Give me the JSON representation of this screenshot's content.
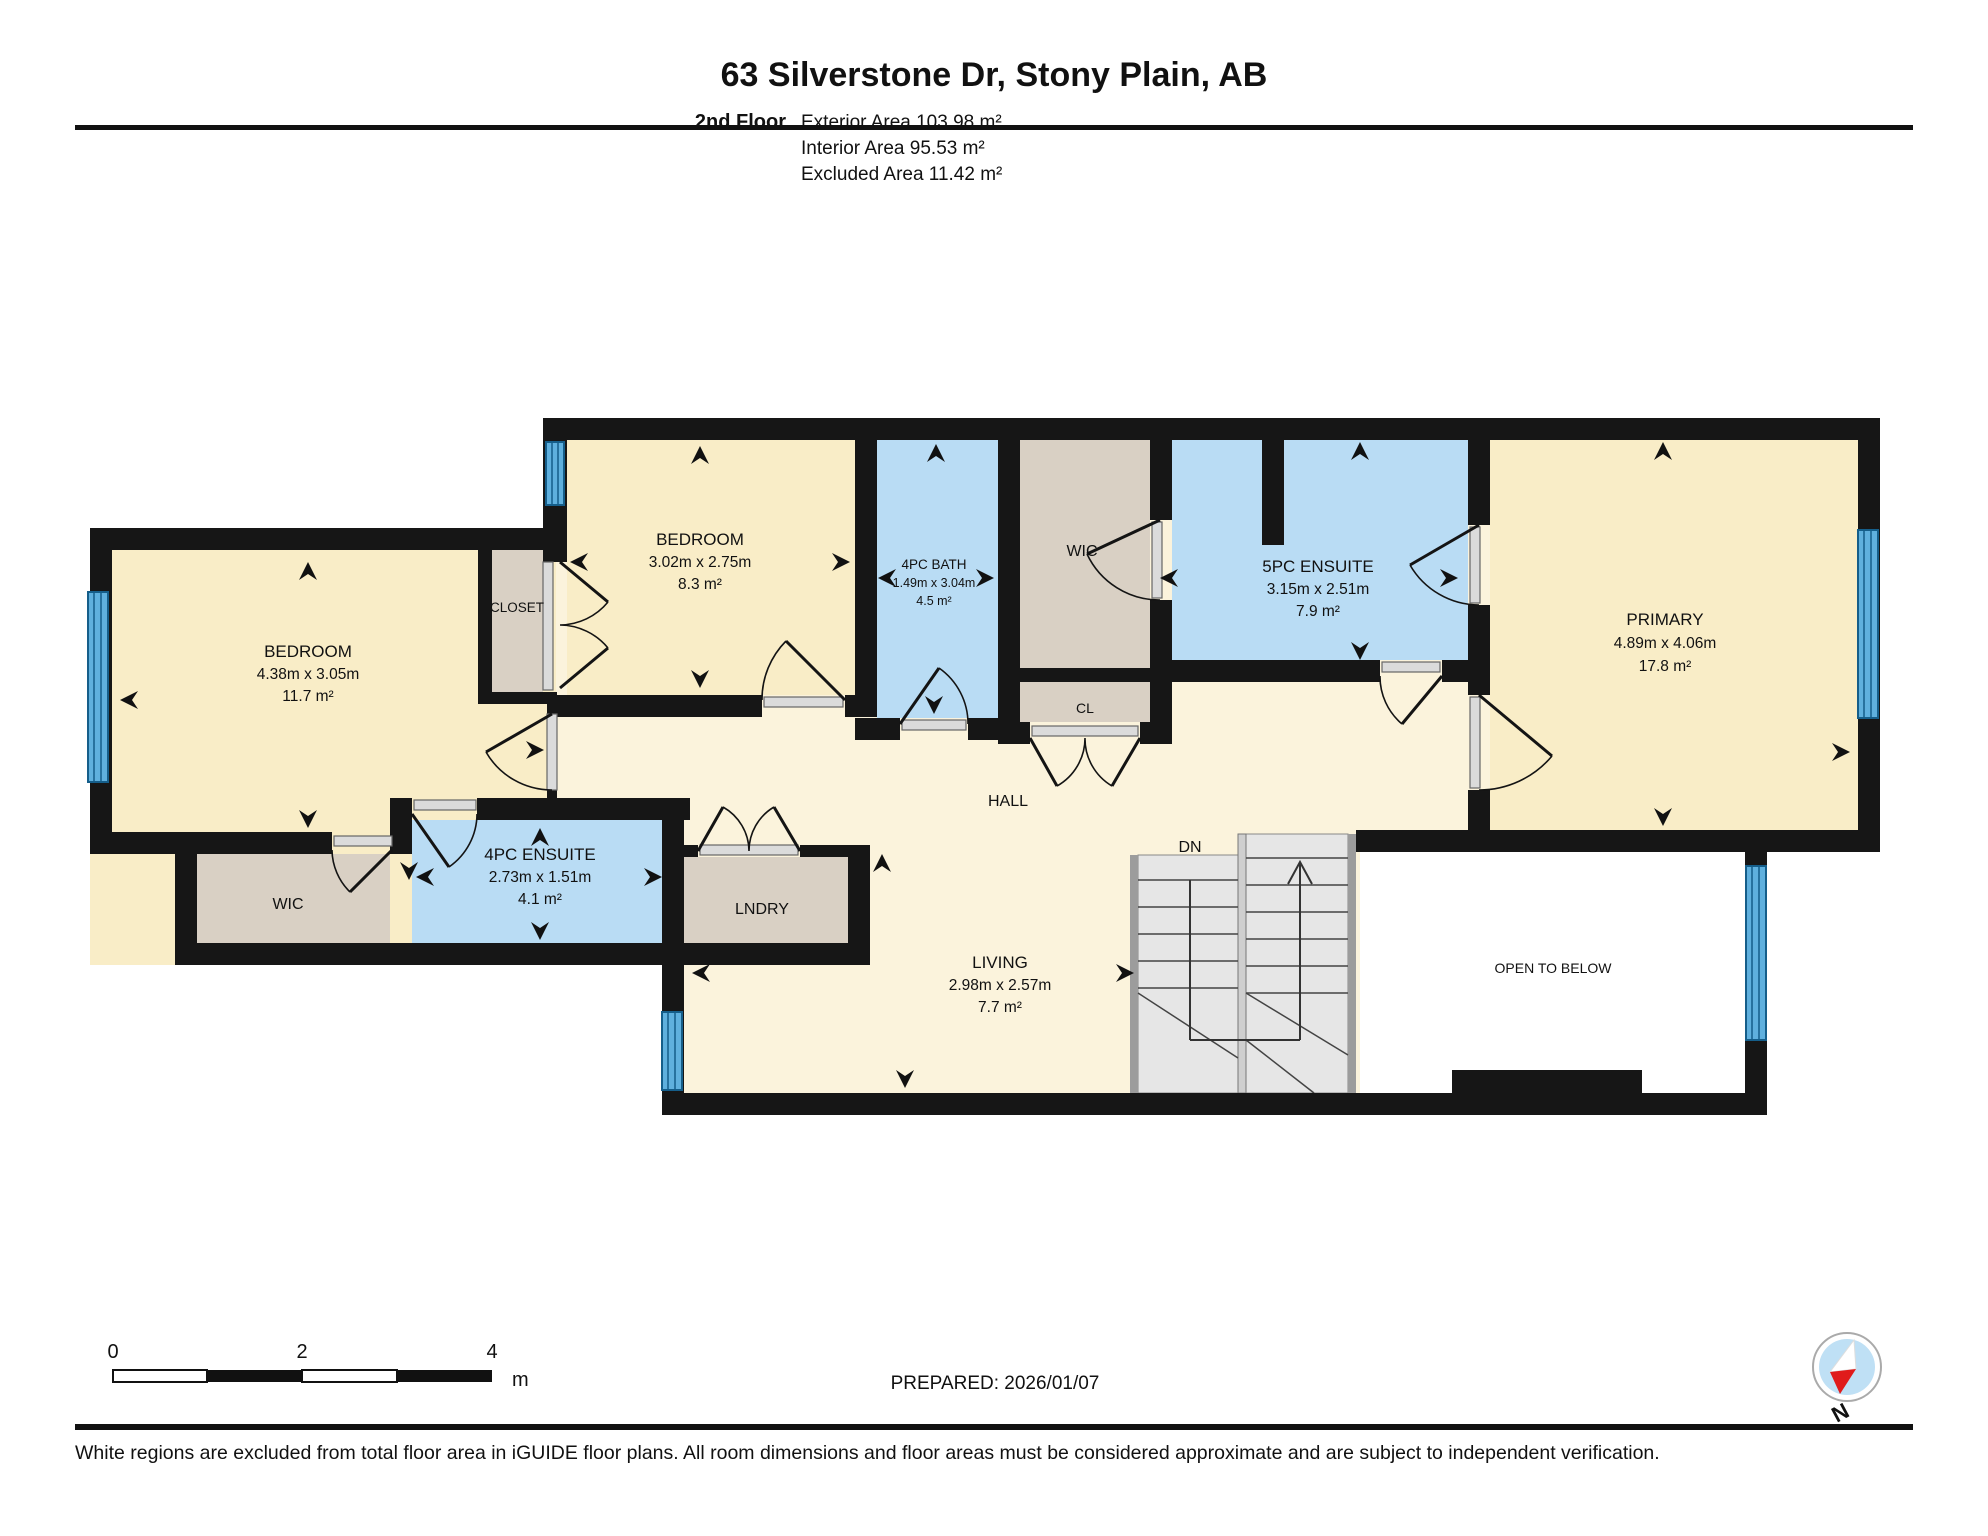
{
  "header": {
    "title": "63 Silverstone Dr, Stony Plain, AB",
    "floor_label": "2nd Floor",
    "area_lines": [
      "Exterior Area 103.98 m²",
      "Interior Area 95.53 m²",
      "Excluded Area 11.42 m²"
    ]
  },
  "rooms": {
    "bedroom_left": {
      "name": "BEDROOM",
      "dims": "4.38m x 3.05m",
      "area": "11.7 m²"
    },
    "bedroom_mid": {
      "name": "BEDROOM",
      "dims": "3.02m x 2.75m",
      "area": "8.3 m²"
    },
    "bath": {
      "name": "4PC BATH",
      "dims": "1.49m x 3.04m",
      "area": "4.5 m²"
    },
    "ensuite4": {
      "name": "4PC ENSUITE",
      "dims": "2.73m x 1.51m",
      "area": "4.1 m²"
    },
    "ensuite5": {
      "name": "5PC ENSUITE",
      "dims": "3.15m x 2.51m",
      "area": "7.9 m²"
    },
    "primary": {
      "name": "PRIMARY",
      "dims": "4.89m x 4.06m",
      "area": "17.8 m²"
    },
    "living": {
      "name": "LIVING",
      "dims": "2.98m x 2.57m",
      "area": "7.7 m²"
    },
    "closet": "CLOSET",
    "wic_left": "WIC",
    "wic_mid": "WIC",
    "cl": "CL",
    "lndry": "LNDRY",
    "hall": "HALL",
    "dn": "DN",
    "open_to_below": "OPEN TO BELOW"
  },
  "scale_bar": {
    "tick0": "0",
    "tick2": "2",
    "tick4": "4",
    "unit": "m"
  },
  "footer": {
    "prepared": "PREPARED: 2026/01/07",
    "disclaimer": "White regions are excluded from total floor area in iGUIDE floor plans. All room dimensions and floor areas must be considered approximate and are subject to independent verification.",
    "compass": "N"
  },
  "colors": {
    "room_cream": "#F9EDC7",
    "hall_cream": "#FBF3DC",
    "wet_blue": "#B9DCF4",
    "closet_tan": "#D9D0C4",
    "wall_black": "#161616",
    "window_blue": "#5FB0DE",
    "stair_gray": "#E6E6E6",
    "compass_blue": "#BFE0F5",
    "compass_red": "#E01B1B"
  }
}
